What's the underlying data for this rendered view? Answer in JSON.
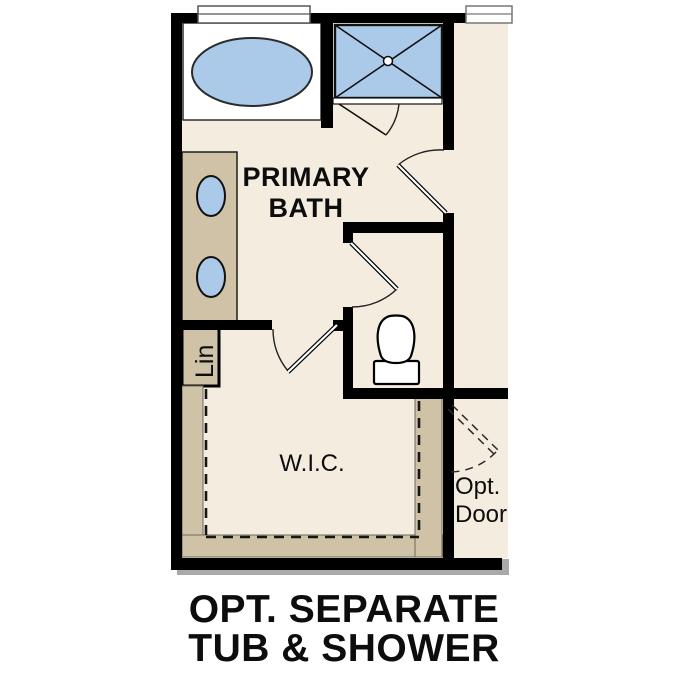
{
  "plan": {
    "rooms": {
      "primary_bath": {
        "label_line1": "PRIMARY",
        "label_line2": "BATH"
      },
      "wic": {
        "label": "W.I.C."
      },
      "linen": {
        "label": "Lin"
      },
      "optional_door": {
        "label_line1": "Opt.",
        "label_line2": "Door"
      }
    },
    "caption": {
      "line1": "OPT. SEPARATE",
      "line2": "TUB & SHOWER"
    },
    "fixtures": [
      "oval-bathtub",
      "shower-pan-with-drain",
      "toilet",
      "vanity-sink",
      "vanity-sink",
      "window",
      "window",
      "linen-closet",
      "closet-rod"
    ],
    "colors": {
      "floor": "#f3ecdf",
      "cabinet_tan": "#cfc2a7",
      "fixture_blue": "#abcae9",
      "wall": "#000000",
      "shadow": "#a9a9a9"
    }
  }
}
